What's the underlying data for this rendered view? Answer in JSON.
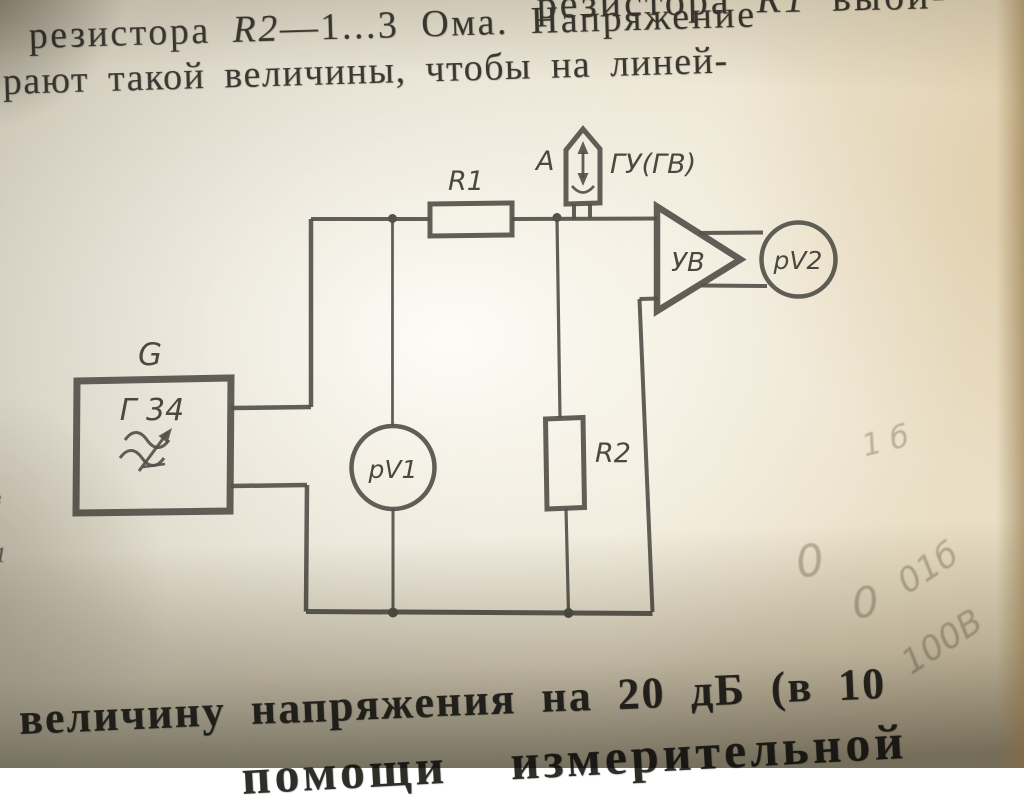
{
  "text": {
    "top": {
      "line1_prefix": "резистора ",
      "line1_ref": "R1",
      "line1_suffix": " выби-",
      "line2_prefix": "резистора ",
      "line2_ref": "R2",
      "line2_suffix": "—1...3 Ома. Напряжение",
      "line3": "рают такой величины, чтобы на линей-"
    },
    "bottom": {
      "line1": "величину напряжения на 20 дБ (в 10",
      "line2_cut": "помощи  измерительной"
    },
    "left_edge": {
      "frag1": "з",
      "frag2": "1"
    }
  },
  "diagram": {
    "generator": {
      "top_label": "G",
      "inner_label": "Г 34"
    },
    "r1_label": "R1",
    "r2_label": "R2",
    "probe": {
      "left_label": "A",
      "right_label": "ГУ(ГВ)"
    },
    "amplifier_label": "УВ",
    "voltmeter1_label": "pV1",
    "voltmeter2_label": "pV2"
  },
  "handwriting": {
    "h1": "1 б",
    "h2": "0",
    "h3": "0",
    "h4": "01б",
    "h5": "100В"
  },
  "colors": {
    "ink": "#54514a",
    "print_text": "#3b3831",
    "paper_center": "#fdfcf6",
    "paper_edge": "#d0cabb",
    "bottom_shadow": "#7e7a6c",
    "pencil": "#7d705a"
  }
}
